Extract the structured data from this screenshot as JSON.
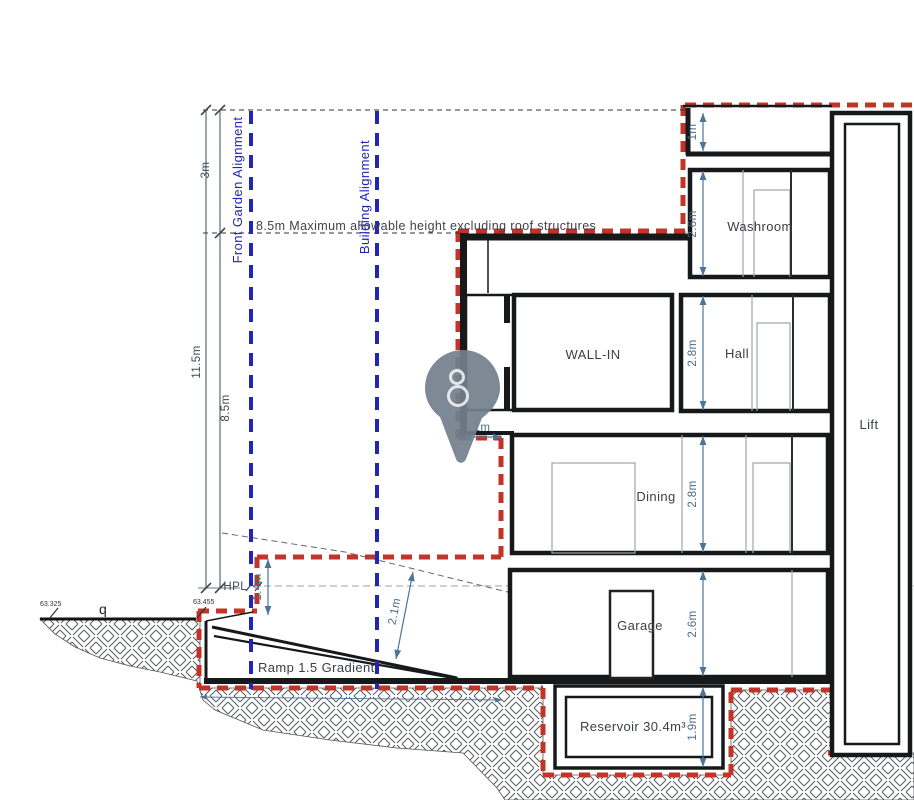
{
  "labels": {
    "front_garden_alignment": "Front Garden Alignment",
    "building_alignment": "Building Alignment",
    "max_height_note": "8.5m Maximum allowable height excluding roof structures",
    "hpl": "HPL",
    "ramp": "Ramp 1.5 Gradient",
    "survey_q": "q",
    "level_left": "63.325",
    "level_right": "63.455"
  },
  "rooms": {
    "washroom": "Washroom",
    "hall": "Hall",
    "wall_in": "WALL-IN",
    "dining": "Dining",
    "garage": "Garage",
    "lift": "Lift",
    "reservoir": "Reservoir 30.4m³"
  },
  "dimensions": {
    "setback_top": "3m",
    "total_height": "11.5m",
    "max_height": "8.5m",
    "parapet": "1m",
    "washroom_height": "2.6m",
    "hall_height": "2.8m",
    "dining_height": "2.8m",
    "garage_height": "2.6m",
    "reservoir_height": "1.9m",
    "upper_setback": "1m",
    "front_depth": "1.4m",
    "ramp_clearance": "2.1m"
  },
  "colors": {
    "boundary_red": "#c23427",
    "alignment_blue": "#2126b8",
    "dimension_blue": "#4d7396",
    "wall_black": "#17181a",
    "pin_gray": "#72808d"
  }
}
